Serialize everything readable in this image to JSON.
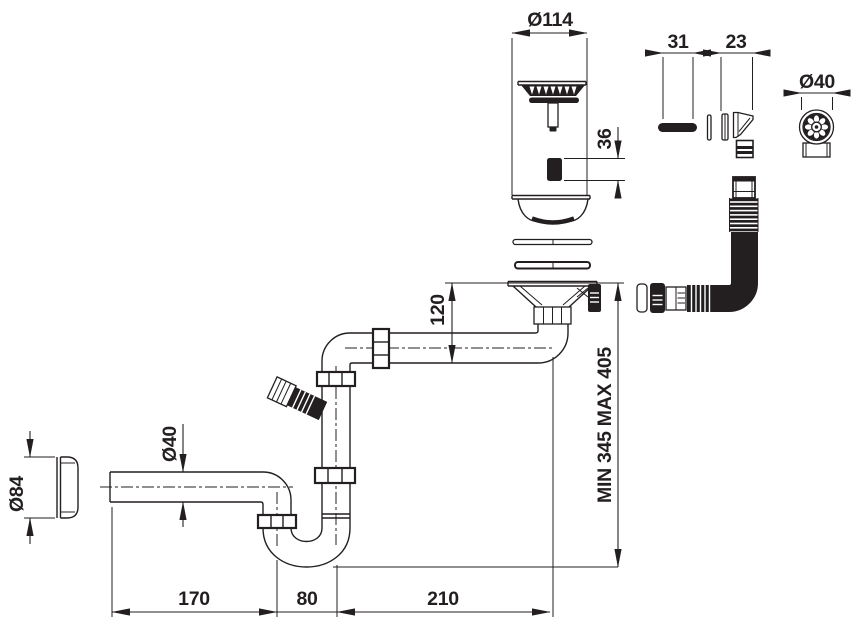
{
  "drawing": {
    "kind": "technical-drawing",
    "subject": "kitchen sink strainer with siphon trap - installation dimensions",
    "colors": {
      "line": "#231f20",
      "background": "#ffffff"
    }
  },
  "dims": {
    "strainer_diameter": "Ø114",
    "screw_height": "36",
    "pin_length": "31",
    "cone_width": "23",
    "hose_end_diameter": "Ø40",
    "drop_height": "120",
    "install_height": "MIN 345 MAX 405",
    "pipe_diameter": "Ø40",
    "cap_diameter": "Ø84",
    "outlet_length": "170",
    "trap_width": "80",
    "offset_length": "210"
  }
}
